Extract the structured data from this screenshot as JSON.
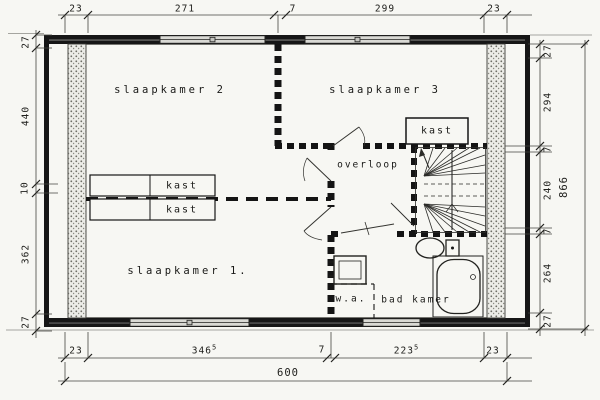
{
  "plan": {
    "rooms": {
      "bedroom2": "slaapkamer 2",
      "bedroom3": "slaapkamer 3",
      "bedroom1": "slaapkamer 1.",
      "landing": "overloop",
      "bathroom": "bad kamer",
      "washing_area": "w.a.",
      "closet": "kast"
    },
    "dimensions": {
      "top": [
        "23",
        "271",
        "7",
        "299",
        "23"
      ],
      "bottom": [
        "23",
        "346",
        "7",
        "223",
        "23"
      ],
      "bottom_sup": "5",
      "bottom_overall": "600",
      "left": [
        "27",
        "440",
        "10",
        "362",
        "27"
      ],
      "right": [
        "27",
        "294",
        "7",
        "240",
        "7",
        "264",
        "27"
      ],
      "right_overall": "866"
    },
    "colors": {
      "ink": "#1b1b1b",
      "paper": "#f7f7f3",
      "window_fill": "#d9d9d4",
      "wall_stipple": "#77756e"
    }
  }
}
